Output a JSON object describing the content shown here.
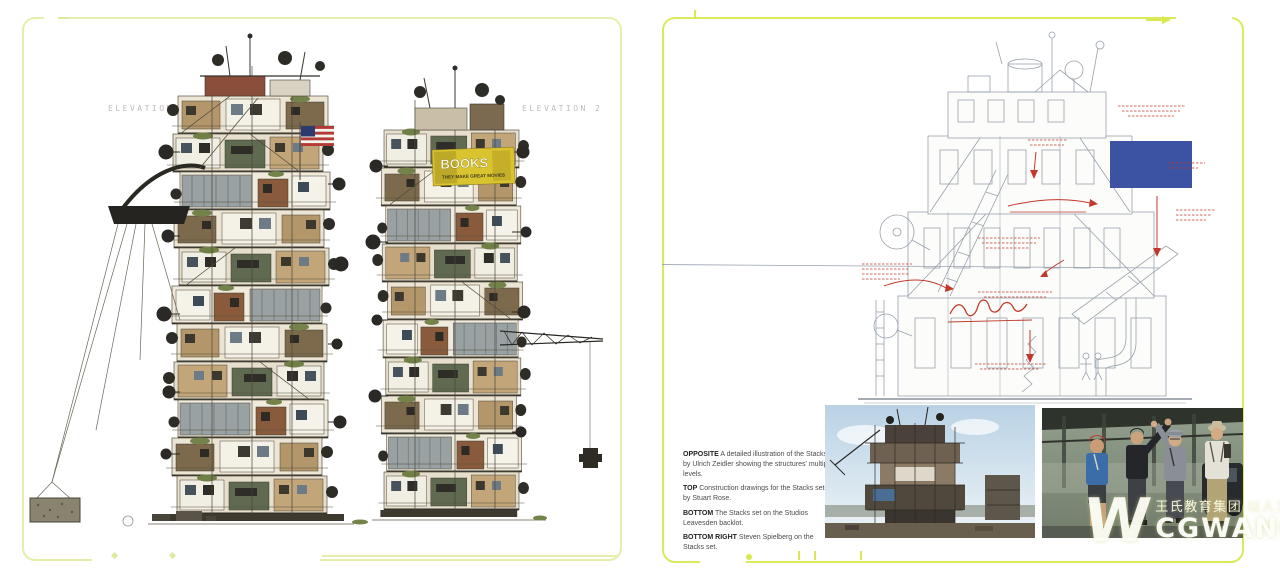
{
  "page_left": {
    "elevation1_label": "ELEVATION 1",
    "elevation2_label": "ELEVATION 2",
    "billboard_title": "BOOKS",
    "billboard_subtitle": "THEY MAKE GREAT MOVIES"
  },
  "page_right": {
    "captions": [
      {
        "lead": "OPPOSITE",
        "text": "A detailed illustration of the Stacks by Ulrich Zeidler showing the structures' multiple levels."
      },
      {
        "lead": "TOP",
        "text": "Construction drawings for the Stacks sets by Stuart Rose."
      },
      {
        "lead": "BOTTOM",
        "text": "The Stacks set on the Studios Leavesden backlot."
      },
      {
        "lead": "BOTTOM RIGHT",
        "text": "Steven Spielberg on the Stacks set."
      }
    ]
  },
  "watermark": {
    "logo": "W",
    "chinese": "王氏教育集团:以人为本",
    "brand": "CGWANG",
    "suffix": ".COM"
  },
  "colors": {
    "frame_left": "#e7edac",
    "frame_right": "#dbe95c",
    "blueprint_blue": "#3c53a4",
    "annotation_red": "#c0392b",
    "billboard_yellow": "#d9c32f"
  }
}
